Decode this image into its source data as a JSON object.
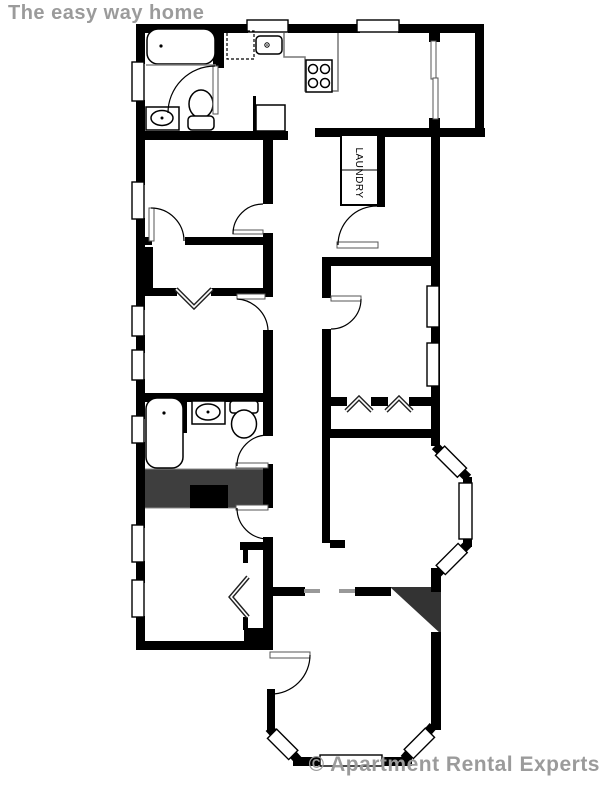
{
  "header": {
    "title": "The easy way home"
  },
  "watermark": {
    "text": "© Apartment Rental Experts"
  },
  "plan": {
    "labels": {
      "laundry": "LAUNDRY"
    },
    "colors": {
      "walls": "#000000",
      "gray_text": "#9b9b9b",
      "stairs_fill": "#3e3e3e",
      "background": "#ffffff"
    },
    "fixtures": [
      "bathtub",
      "bathroom-sink",
      "toilet",
      "dishwasher",
      "kitchen-sink",
      "stove",
      "refrigerator",
      "laundry-closet",
      "sliding-door",
      "second-bathtub",
      "second-sink",
      "second-toilet",
      "staircase",
      "bifold-closet-doors",
      "bay-windows"
    ]
  }
}
